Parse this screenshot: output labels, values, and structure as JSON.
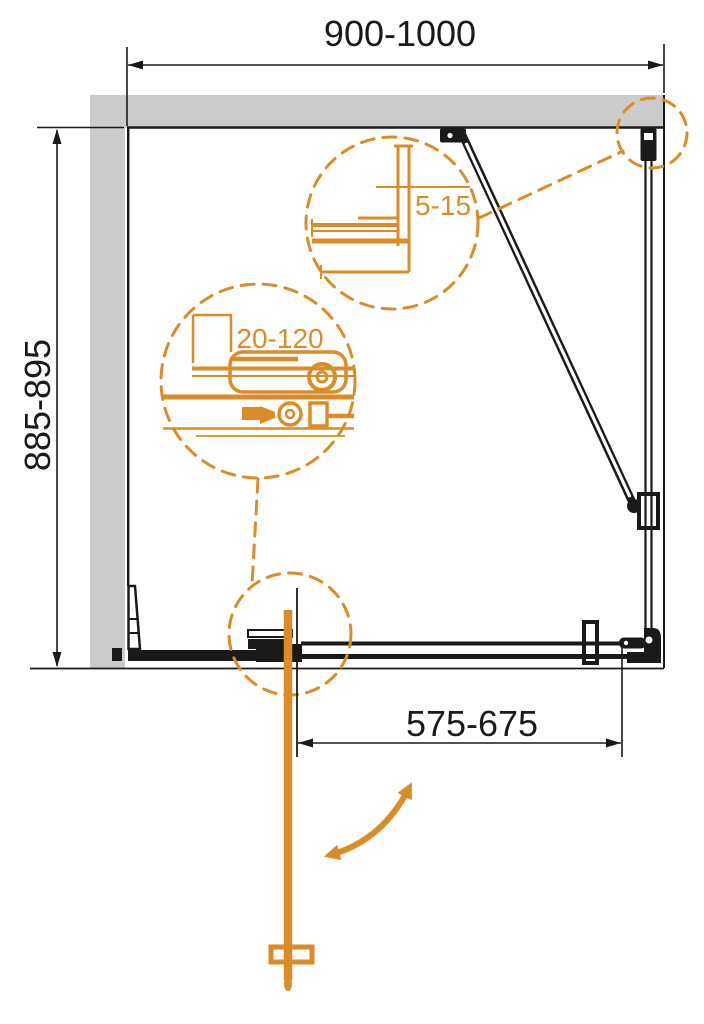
{
  "labels": {
    "width_range": "900-1000",
    "depth_range": "885-895",
    "door_opening_range": "575-675",
    "wall_profile_adjustment_range": "5-15",
    "extension_profile_adjustment_range": "20-120"
  },
  "colors": {
    "accent_orange": "#DC8C26",
    "wall_gray": "#CBCBCB",
    "line_black": "#1A1A1A",
    "background": "#FFFFFF"
  }
}
